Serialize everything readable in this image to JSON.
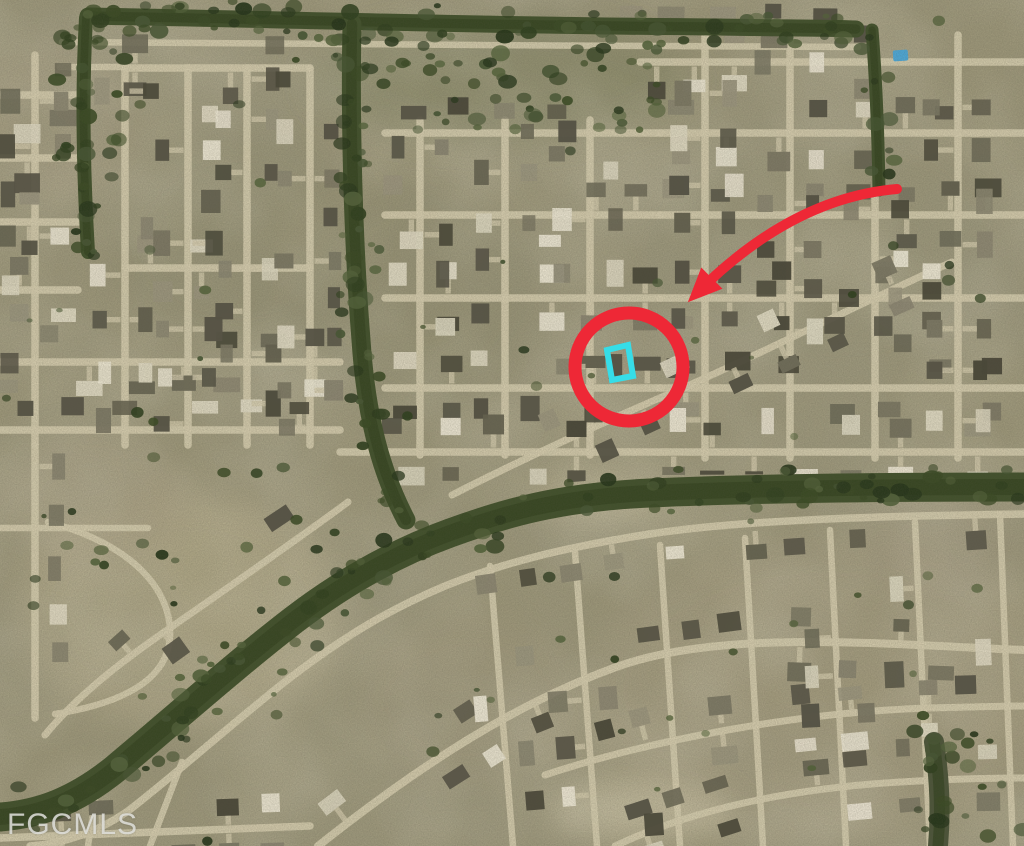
{
  "map": {
    "scene": "aerial satellite view of a residential grid neighborhood with tree-lined canals"
  },
  "watermark": {
    "text": "FGCMLS"
  },
  "annotations": {
    "highlight_circle": {
      "cx": 629,
      "cy": 367,
      "r": 54,
      "stroke_width": 13,
      "color": "#ee2836"
    },
    "parcel_outline": {
      "points": "607,350 628,345 633,376 612,380",
      "stroke_width": 6,
      "color": "#36dde8"
    },
    "pointer_arrow": {
      "path": "M 897 189 Q 792 198 697 293",
      "stroke_width": 10,
      "color": "#ee2836"
    }
  },
  "palette": {
    "ground": "#9c9679",
    "road": "#d3caac",
    "canal": "#41502b",
    "tree": "#2f3f1e",
    "pool": "#4da7d6"
  }
}
